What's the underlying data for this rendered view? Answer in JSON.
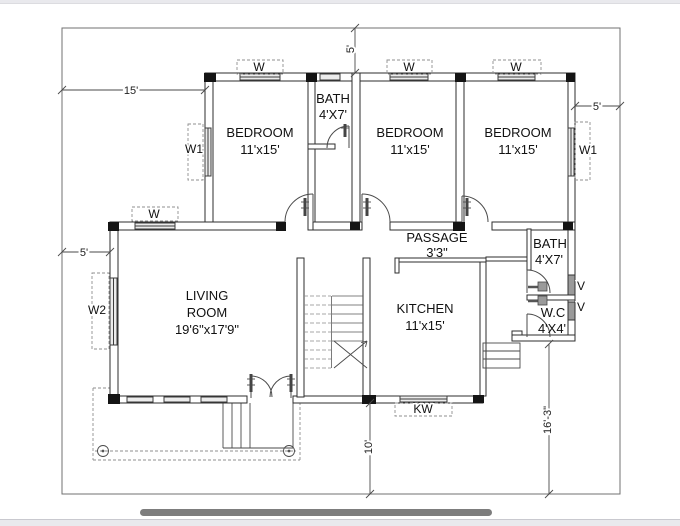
{
  "chrome": {
    "scrollbar_color": "#7d7d7d",
    "strip_color": "#e9e9ed",
    "background": "#ffffff"
  },
  "plan": {
    "line_color": "#2e2e2e",
    "rooms": {
      "bedroom_left": {
        "name": "BEDROOM",
        "size": "11'x15'"
      },
      "bedroom_middle": {
        "name": "BEDROOM",
        "size": "11'x15'"
      },
      "bedroom_right": {
        "name": "BEDROOM",
        "size": "11'x15'"
      },
      "bath_top": {
        "name": "BATH",
        "size": "4'X7'"
      },
      "bath_right": {
        "name": "BATH",
        "size": "4'X7'"
      },
      "wc": {
        "name": "W.C",
        "size": "4'X4'"
      },
      "kitchen": {
        "name": "KITCHEN",
        "size": "11'x15'"
      },
      "living_room": {
        "name_line1": "LIVING",
        "name_line2": "ROOM",
        "size": "19'6\"x17'9\""
      },
      "passage": {
        "name": "PASSAGE",
        "size": "3'3\""
      }
    },
    "window_labels": {
      "w_bedroom_left": "W",
      "w_bedroom_middle": "W",
      "w_bedroom_right": "W",
      "w_living": "W",
      "w1_left": "W1",
      "w1_right": "W1",
      "w2": "W2",
      "kw": "KW",
      "v_bath": "V",
      "v_wc": "V"
    },
    "dimensions": {
      "left_width": "15'",
      "left_offset": "5'",
      "top_offset": "5'",
      "right_offset": "5'",
      "bottom_left_height": "10'",
      "bottom_right_height": "16'-3\""
    }
  }
}
